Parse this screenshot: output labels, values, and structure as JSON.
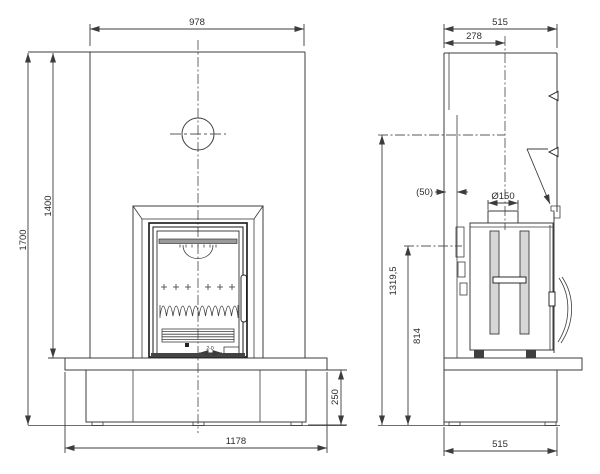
{
  "front": {
    "width_top": "978",
    "opening_height": "1400",
    "total_height": "1700",
    "base_height": "250",
    "base_width": "1178",
    "air_control_range": "2-0"
  },
  "side": {
    "depth_top": "515",
    "flue_center_offset": "278",
    "wall_gap": "(50)",
    "flue_diameter": "Ø150",
    "flue_rear_height": "1319,5",
    "outlet_height": "814",
    "base_depth": "515"
  }
}
